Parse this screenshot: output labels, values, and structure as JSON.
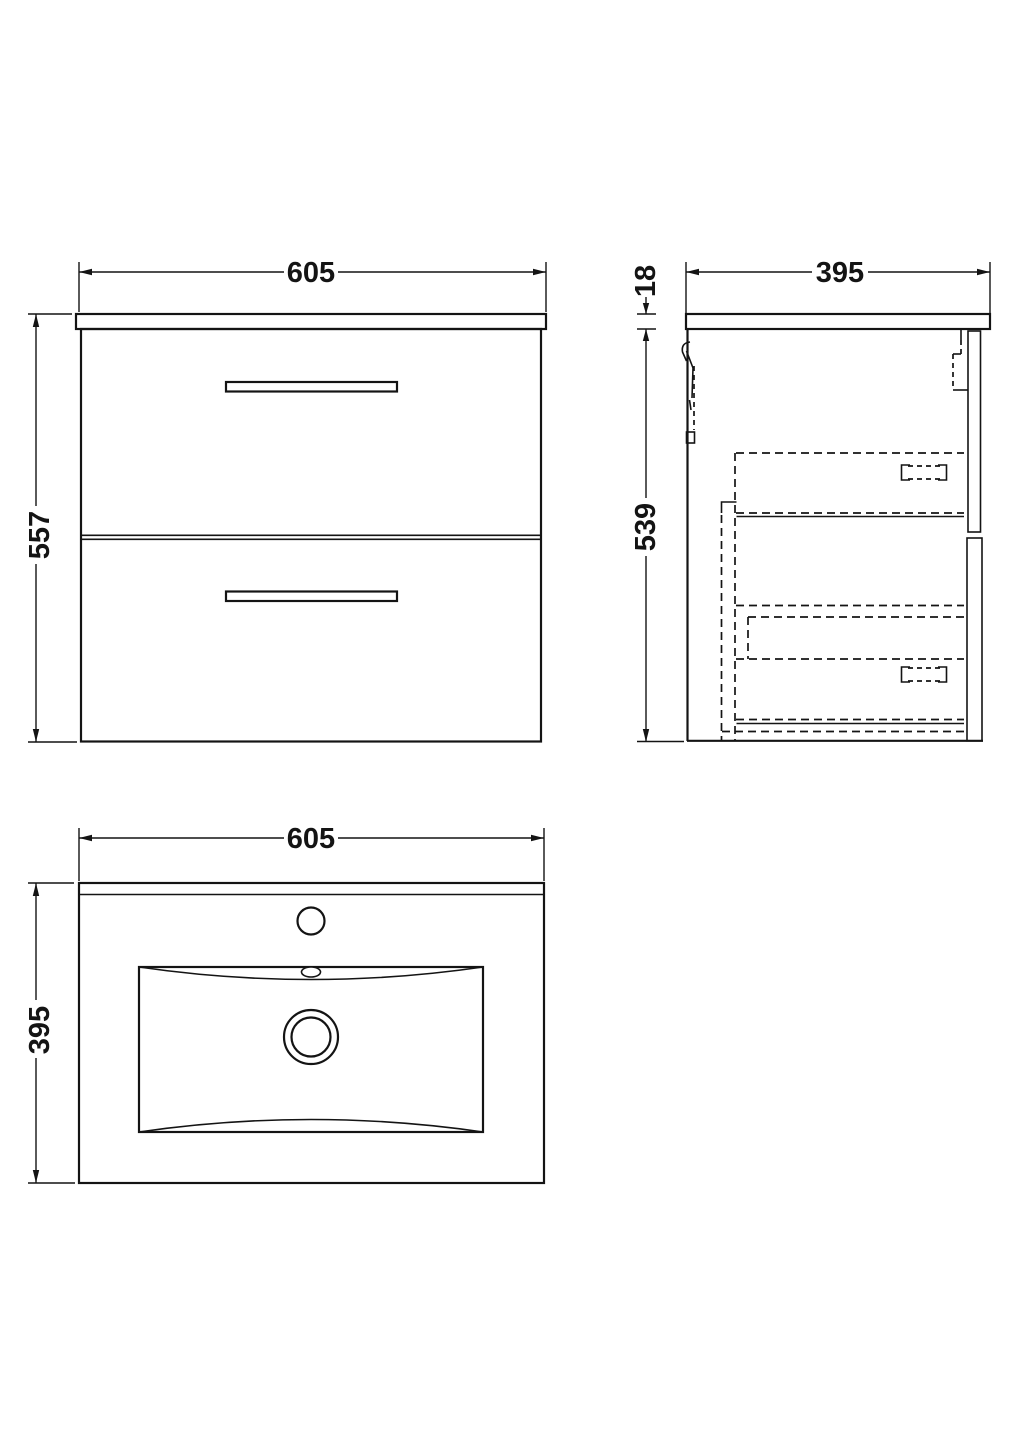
{
  "diagram": {
    "type": "technical-drawing",
    "subject": "wall-hung two-drawer vanity unit with basin",
    "background": "#ffffff",
    "line_color": "#141414",
    "views": {
      "front": {
        "width": "605",
        "height": "557"
      },
      "side": {
        "depth": "395",
        "counter_thickness": "18",
        "cabinet_height": "539"
      },
      "plan": {
        "width": "605",
        "depth": "395"
      }
    }
  }
}
